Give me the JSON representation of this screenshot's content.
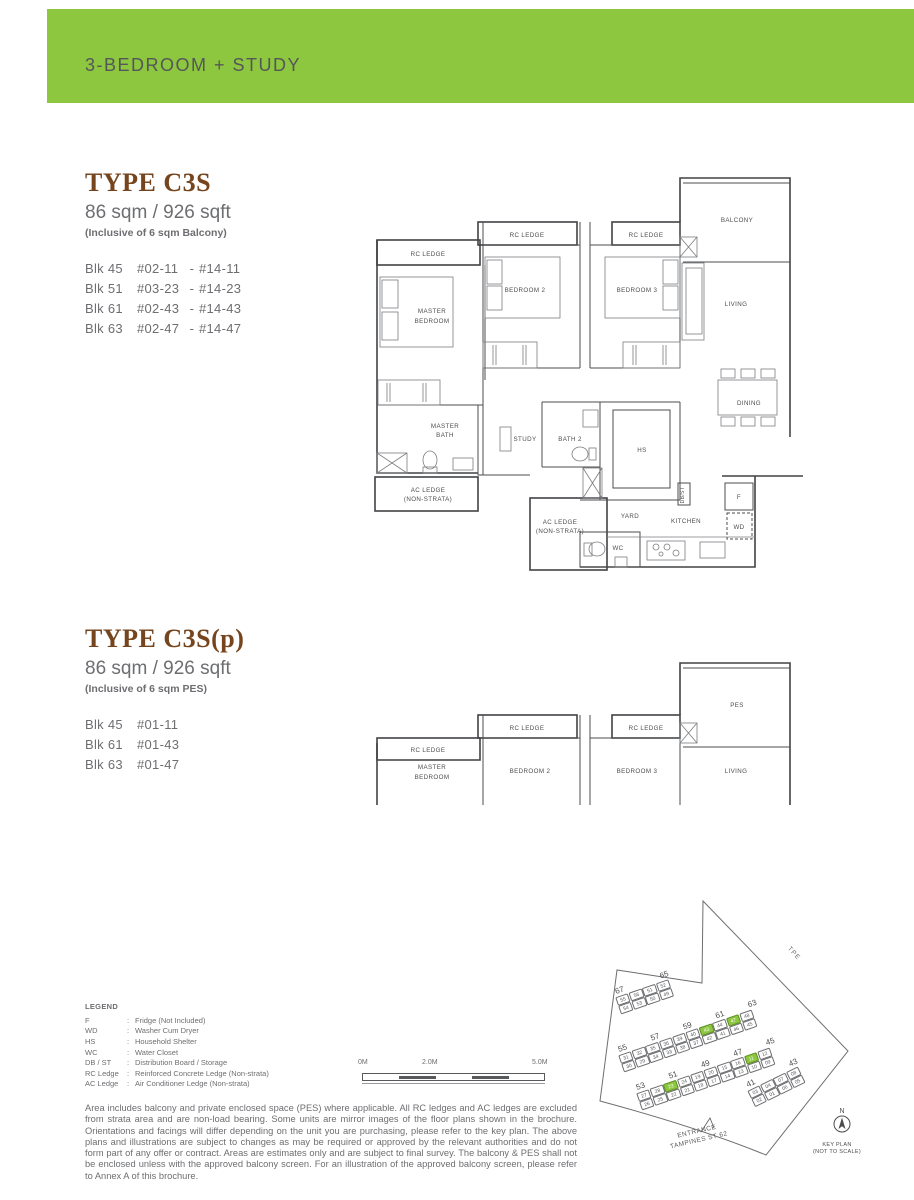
{
  "header": {
    "title": "3-BEDROOM + STUDY",
    "bar_color": "#8dc63f"
  },
  "type1": {
    "title": "TYPE C3S",
    "area": "86 sqm / 926 sqft",
    "note": "(Inclusive of 6 sqm Balcony)",
    "units": [
      {
        "blk": "Blk 45",
        "from": "#02-11",
        "dash": "-",
        "to": "#14-11"
      },
      {
        "blk": "Blk 51",
        "from": "#03-23",
        "dash": "-",
        "to": "#14-23"
      },
      {
        "blk": "Blk 61",
        "from": "#02-43",
        "dash": "-",
        "to": "#14-43"
      },
      {
        "blk": "Blk 63",
        "from": "#02-47",
        "dash": "-",
        "to": "#14-47"
      }
    ]
  },
  "type2": {
    "title": "TYPE C3S(p)",
    "area": "86 sqm / 926 sqft",
    "note": "(Inclusive of 6 sqm PES)",
    "units": [
      {
        "blk": "Blk 45",
        "from": "#01-11"
      },
      {
        "blk": "Blk 61",
        "from": "#01-43"
      },
      {
        "blk": "Blk 63",
        "from": "#01-47"
      }
    ]
  },
  "plan1": {
    "labels": {
      "rc": "RC LEDGE",
      "master1": "MASTER",
      "master2": "BEDROOM",
      "b2": "BEDROOM 2",
      "b3": "BEDROOM 3",
      "balcony": "BALCONY",
      "living": "LIVING",
      "dining": "DINING",
      "mb1": "MASTER",
      "mb2": "BATH",
      "study": "STUDY",
      "bath2": "BATH 2",
      "hs": "HS",
      "ac1": "AC LEDGE",
      "ac2": "(NON-STRATA)",
      "yard": "YARD",
      "kitchen": "KITCHEN",
      "wc": "WC",
      "f": "F",
      "wd": "WD",
      "dbst": "DB/ST"
    }
  },
  "plan2": {
    "labels": {
      "rc": "RC LEDGE",
      "master1": "MASTER",
      "master2": "BEDROOM",
      "b2": "BEDROOM 2",
      "b3": "BEDROOM 3",
      "pes": "PES",
      "living": "LIVING"
    }
  },
  "legend": {
    "title": "LEGEND",
    "sep": ":",
    "items": [
      {
        "abbr": "F",
        "desc": "Fridge (Not Included)"
      },
      {
        "abbr": "WD",
        "desc": "Washer Cum Dryer"
      },
      {
        "abbr": "HS",
        "desc": "Household Shelter"
      },
      {
        "abbr": "WC",
        "desc": "Water Closet"
      },
      {
        "abbr": "DB / ST",
        "desc": "Distribution Board / Storage"
      },
      {
        "abbr": "RC Ledge",
        "desc": "Reinforced Concrete Ledge (Non-strata)"
      },
      {
        "abbr": "AC Ledge",
        "desc": "Air Conditioner Ledge (Non-strata)"
      }
    ]
  },
  "scalebar": {
    "l0": "0M",
    "l2": "2.0M",
    "l5": "5.0M"
  },
  "keyplan": {
    "tpe": "TPE",
    "entrance1": "ENTRANCE",
    "entrance2": "TAMPINES ST 62",
    "north": "N",
    "cap1": "KEY PLAN",
    "cap2": "(NOT TO SCALE)",
    "highlight_color": "#8dc63f",
    "rowA": {
      "labels": [
        "67",
        "65"
      ],
      "top": [
        {
          "n": "55"
        },
        {
          "n": "56"
        },
        {
          "n": "51"
        },
        {
          "n": "52"
        }
      ],
      "bot": [
        {
          "n": "54"
        },
        {
          "n": "53"
        },
        {
          "n": "50"
        },
        {
          "n": "49"
        }
      ]
    },
    "rowB": {
      "labels": [
        "55",
        "57",
        "59",
        "61",
        "63"
      ],
      "top": [
        {
          "n": "31"
        },
        {
          "n": "32"
        },
        {
          "n": "35"
        },
        {
          "n": "36"
        },
        {
          "n": "39"
        },
        {
          "n": "40"
        },
        {
          "n": "43",
          "g": 1
        },
        {
          "n": "44"
        },
        {
          "n": "47",
          "g": 1
        },
        {
          "n": "48"
        }
      ],
      "bot": [
        {
          "n": "30"
        },
        {
          "n": "29"
        },
        {
          "n": "34"
        },
        {
          "n": "33"
        },
        {
          "n": "38"
        },
        {
          "n": "37"
        },
        {
          "n": "42"
        },
        {
          "n": "41"
        },
        {
          "n": "46"
        },
        {
          "n": "45"
        }
      ]
    },
    "rowC": {
      "labels": [
        "53",
        "51",
        "49",
        "47",
        "45"
      ],
      "top": [
        {
          "n": "27"
        },
        {
          "n": "28"
        },
        {
          "n": "23",
          "g": 1
        },
        {
          "n": "24"
        },
        {
          "n": "19"
        },
        {
          "n": "20"
        },
        {
          "n": "15"
        },
        {
          "n": "16"
        },
        {
          "n": "11",
          "g": 1
        },
        {
          "n": "12"
        }
      ],
      "bot": [
        {
          "n": "26"
        },
        {
          "n": "25"
        },
        {
          "n": "22"
        },
        {
          "n": "21"
        },
        {
          "n": "18"
        },
        {
          "n": "17"
        },
        {
          "n": "14"
        },
        {
          "n": "13"
        },
        {
          "n": "10"
        },
        {
          "n": "09"
        }
      ]
    },
    "rowD": {
      "labels": [
        "41",
        "43"
      ],
      "top": [
        {
          "n": "03"
        },
        {
          "n": "04"
        },
        {
          "n": "07"
        },
        {
          "n": "08"
        }
      ],
      "bot": [
        {
          "n": "02"
        },
        {
          "n": "01"
        },
        {
          "n": "06"
        },
        {
          "n": "05"
        }
      ]
    }
  },
  "disclaimer": "Area includes balcony and private enclosed space (PES) where applicable. All RC ledges and AC ledges are excluded from strata area and are non-load bearing. Some units are mirror images of the floor plans shown in the brochure. Orientations and facings will differ depending on the unit you are purchasing, please refer to the key plan. The above plans and illustrations are subject to changes as may be required or approved by the relevant authorities and do not form part of any offer or contract. Areas are estimates only and are subject to final survey. The balcony & PES shall not be enclosed unless with the approved balcony screen. For an illustration of the approved balcony screen, please refer to Annex A of this brochure."
}
